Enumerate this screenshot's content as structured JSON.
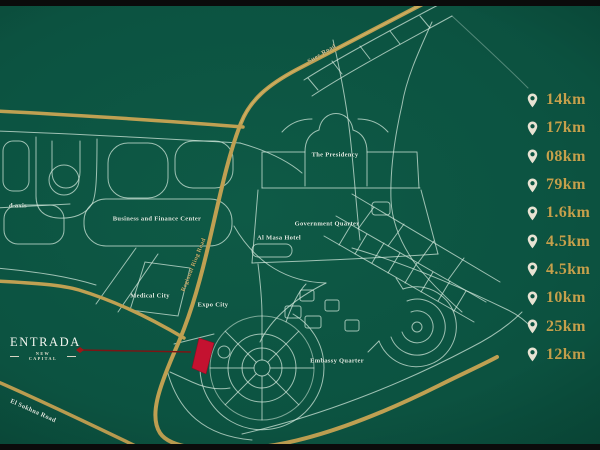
{
  "logo": {
    "title": "ENTRADA",
    "subtitle": "NEW CAPITAL"
  },
  "map_labels": {
    "axis_partial": "d axis",
    "business_finance": "Business and Finance Center",
    "medical_city": "Medical City",
    "al_masa_hotel": "Al Masa Hotel",
    "presidency": "The Presidency",
    "government_quarter": "Government Quarter",
    "expo_city": "Expo City",
    "embassy_quarter": "Embassy Quarter"
  },
  "road_labels": {
    "suez": "Suez Road",
    "ring": "Regional Ring Road",
    "sokhna": "El Sokhna Road"
  },
  "distances": [
    {
      "icon": "map-pin-icon",
      "value": "14km"
    },
    {
      "icon": "map-pin-icon",
      "value": "17km"
    },
    {
      "icon": "map-pin-icon",
      "value": "08km"
    },
    {
      "icon": "map-pin-icon",
      "value": "79km"
    },
    {
      "icon": "map-pin-icon",
      "value": "1.6km"
    },
    {
      "icon": "map-pin-icon",
      "value": "4.5km"
    },
    {
      "icon": "map-pin-icon",
      "value": "4.5km"
    },
    {
      "icon": "map-pin-icon",
      "value": "10km"
    },
    {
      "icon": "map-pin-icon",
      "value": "25km"
    },
    {
      "icon": "map-pin-icon",
      "value": "12km"
    }
  ],
  "colors": {
    "background_green": "#0c5341",
    "gold_road": "#bfa052",
    "light_road": "#d7ecdf",
    "distance_text_gold": "#c5a14c",
    "pin_cream": "#e8e3d3",
    "plot_red": "#c41230",
    "letterbox_black": "#0b0b0b"
  }
}
